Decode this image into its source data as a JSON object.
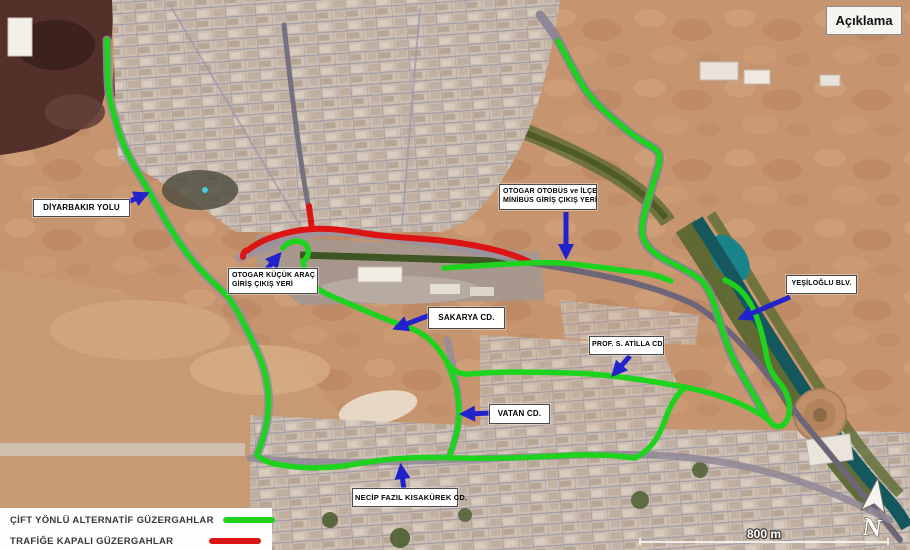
{
  "title": "Açıklama",
  "colors": {
    "alternative_route": "#1ed31e",
    "closed_route": "#dc1414",
    "arrow": "#2222cc"
  },
  "legend": {
    "items": [
      {
        "label": "ÇİFT YÖNLÜ ALTERNATİF GÜZERGAHLAR",
        "color": "#1ed31e"
      },
      {
        "label": "TRAFİĞE KAPALI GÜZERGAHLAR",
        "color": "#dc1414"
      }
    ]
  },
  "map_labels": {
    "diyarbakir_yolu": "DİYARBAKIR YOLU",
    "otogar_kucuk_arac": {
      "line1": "OTOGAR KÜÇÜK ARAÇ",
      "line2": "GİRİŞ ÇIKIŞ YERİ"
    },
    "otogar_otobus": {
      "line1": "OTOGAR OTOBÜS ve İLÇE",
      "line2": "MİNİBÜS GİRİŞ ÇIKIŞ YERİ"
    },
    "sakarya": "SAKARYA CD.",
    "prof_s_atilla": "PROF. S. ATİLLA CD.",
    "vatan": "VATAN CD.",
    "yesiloglu": "YEŞİLOĞLU BLV.",
    "necip_fazil": "NECİP FAZIL KISAKÜREK CD."
  },
  "scale": {
    "label": "800 m"
  },
  "compass": {
    "label": "N"
  }
}
